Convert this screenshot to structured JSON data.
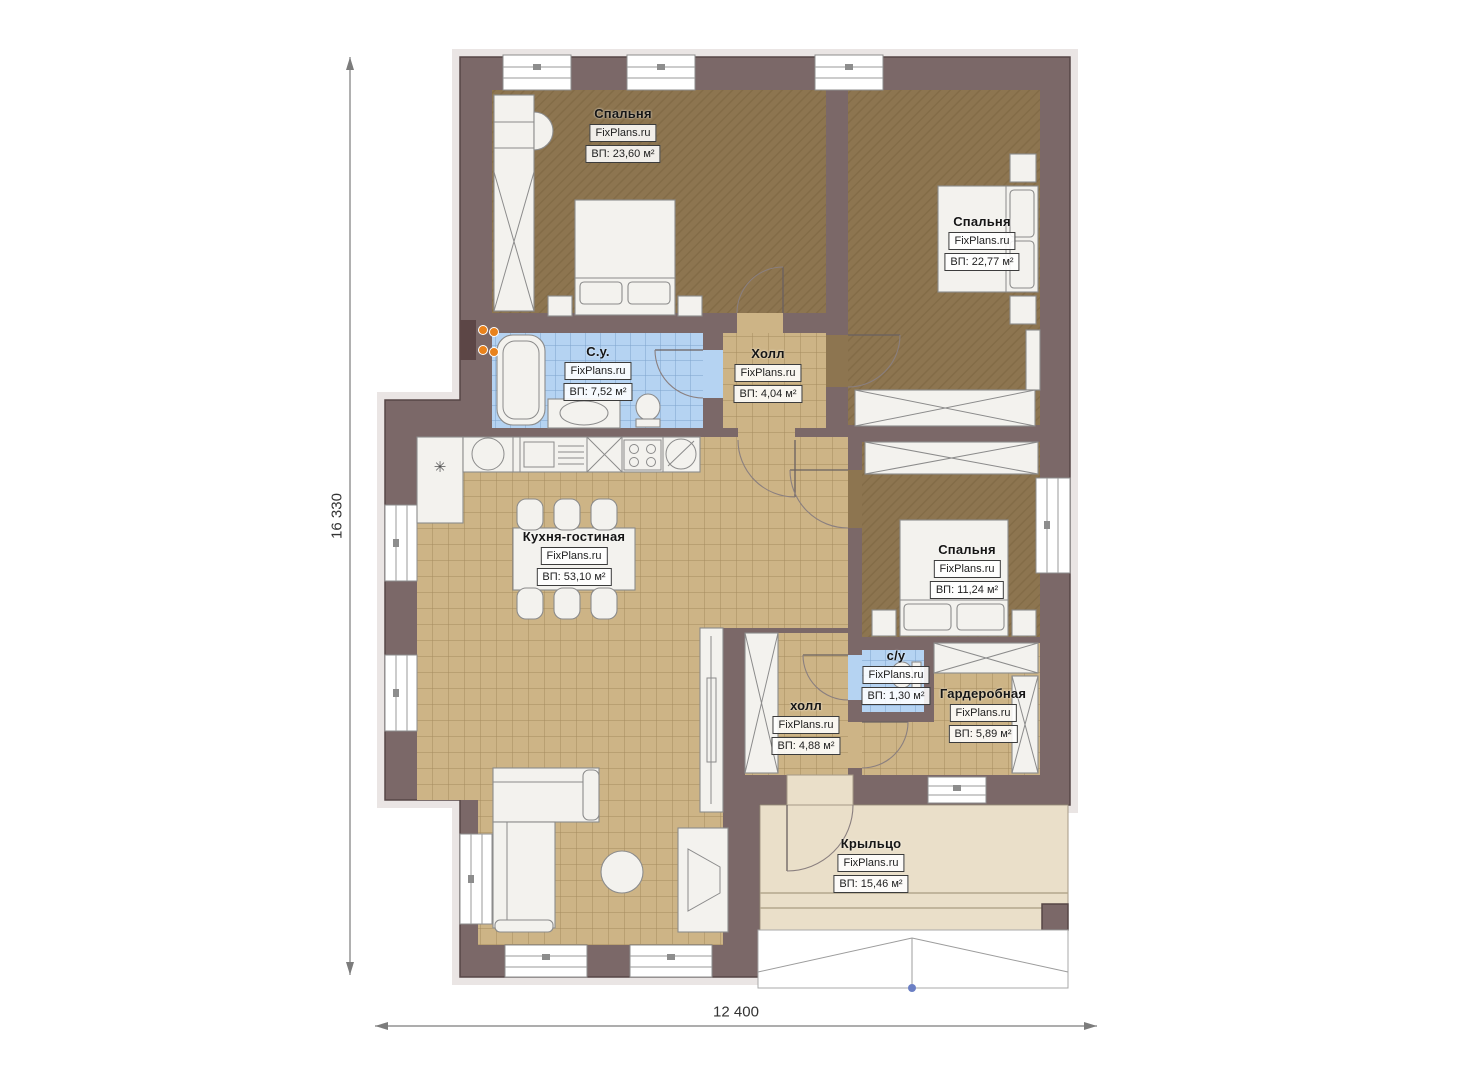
{
  "watermark": "FixPlans.ru",
  "rooms": {
    "bedroom1": {
      "name": "Спальня",
      "area": "ВП: 23,60 м²"
    },
    "bedroom2": {
      "name": "Спальня",
      "area": "ВП: 22,77 м²"
    },
    "bathroom": {
      "name": "С.у.",
      "area": "ВП: 7,52 м²"
    },
    "hall1": {
      "name": "Холл",
      "area": "ВП: 4,04 м²"
    },
    "kitchen": {
      "name": "Кухня-гостиная",
      "area": "ВП: 53,10 м²"
    },
    "bedroom3": {
      "name": "Спальня",
      "area": "ВП: 11,24 м²"
    },
    "wc2": {
      "name": "с/у",
      "area": "ВП: 1,30 м²"
    },
    "wardrobe": {
      "name": "Гардеробная",
      "area": "ВП: 5,89 м²"
    },
    "hall2": {
      "name": "холл",
      "area": "ВП: 4,88 м²"
    },
    "porch": {
      "name": "Крыльцо",
      "area": "ВП: 15,46 м²"
    }
  },
  "dimensions": {
    "height": "16 330",
    "width": "12 400"
  },
  "icons": {
    "snowflake": "✳"
  },
  "colors": {
    "wall": "#7b6868",
    "floor_bed": "#8d7550",
    "floor_tile": "#cdb486",
    "floor_bath": "#b5d3f2",
    "floor_porch": "#eadfc9",
    "furn": "#f3f2ee",
    "radiator": "#e8821c",
    "dim_line": "#7c7c7c"
  }
}
